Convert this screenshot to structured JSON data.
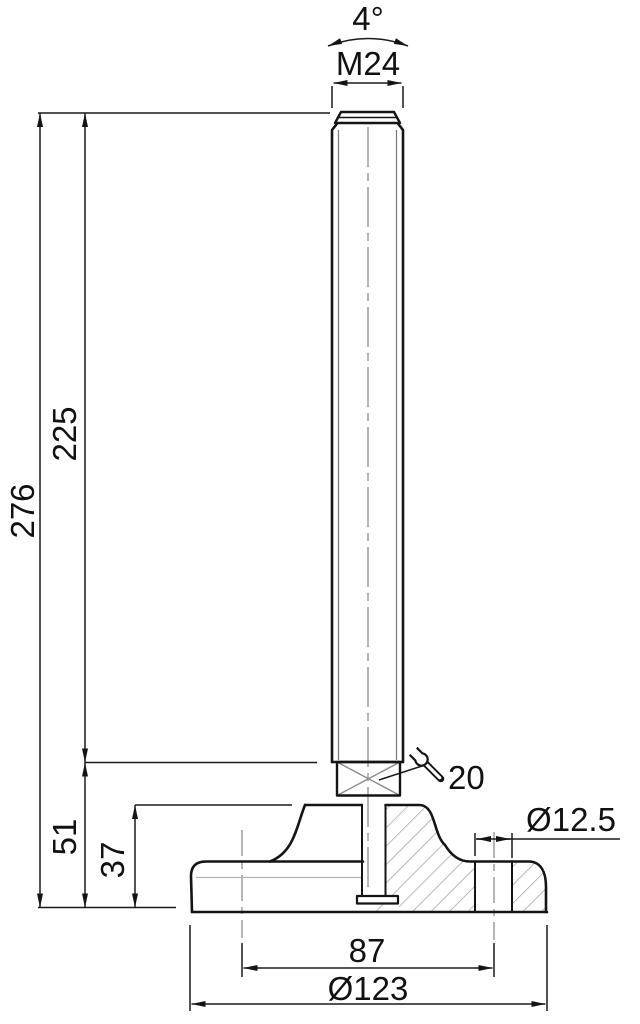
{
  "drawing": {
    "kind": "technical-dimension-drawing",
    "dimensions": {
      "swivel_angle": "4°",
      "thread": "M24",
      "total_height": "276",
      "spindle_length": "225",
      "base_section_height": "51",
      "base_height": "37",
      "wrench_size": "20",
      "hole_diameter": "Ø12.5",
      "hole_spacing": "87",
      "base_diameter": "Ø123"
    },
    "colors": {
      "outline": "#141414",
      "dimension_line": "#1a1a1a",
      "auxiliary_gray": "#8f8f8f",
      "hatch_gray": "#9c9c9c",
      "background": "#ffffff"
    }
  }
}
